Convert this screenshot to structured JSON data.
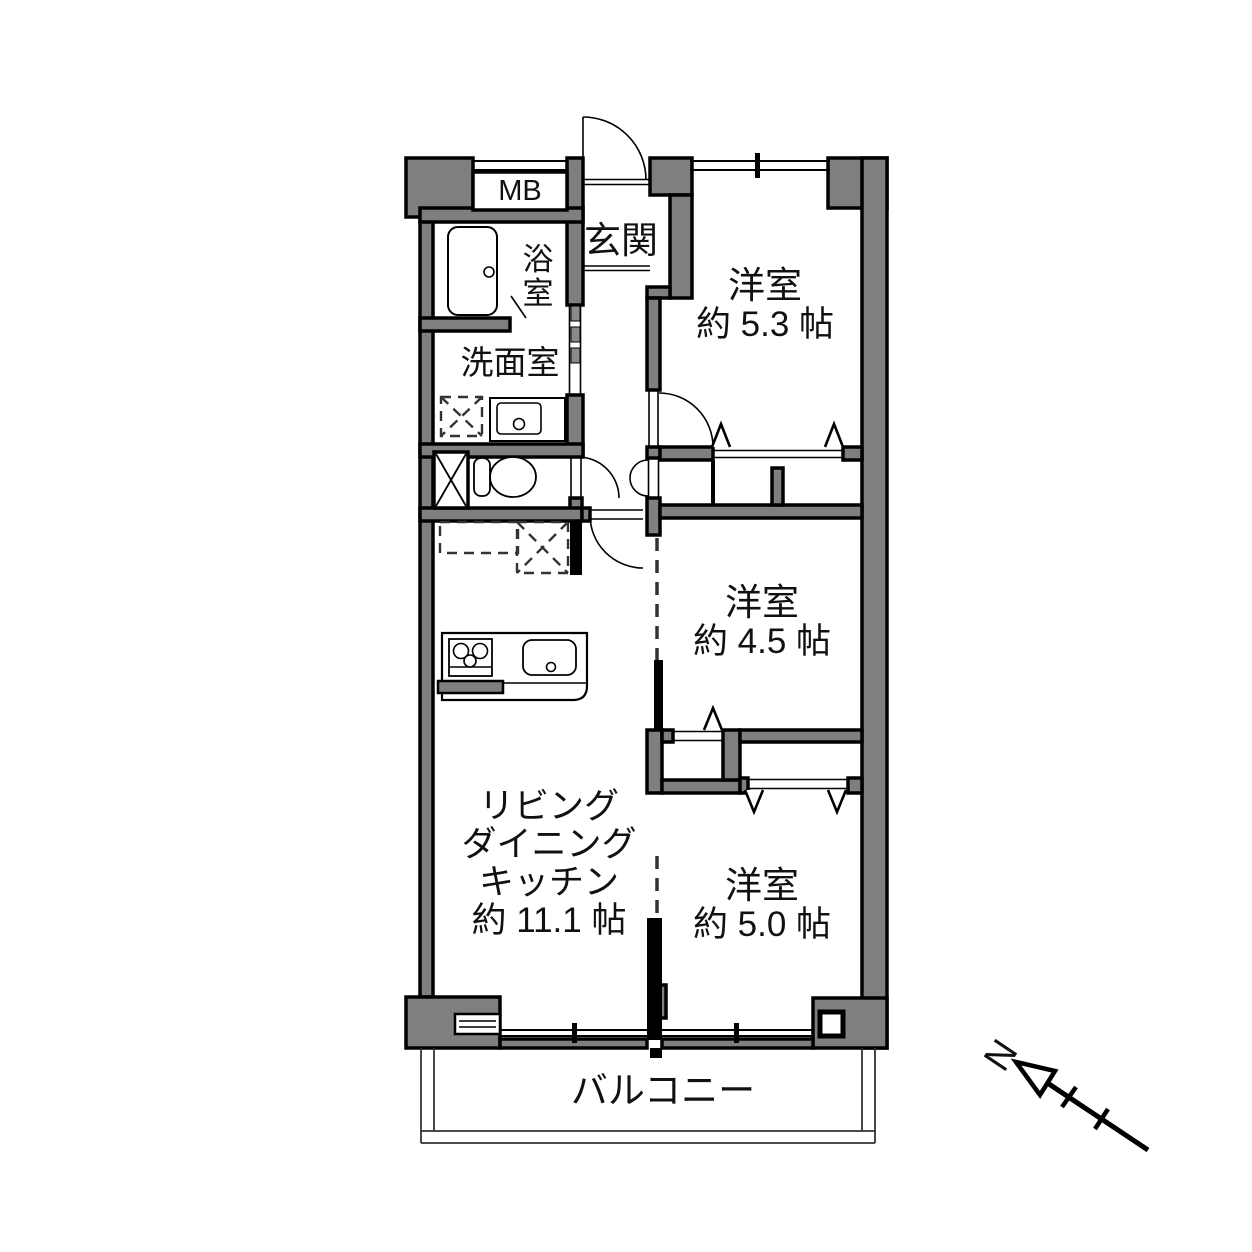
{
  "plan": {
    "type": "apartment-floor-plan",
    "rooms": {
      "bedroom_upper": {
        "name": "洋室",
        "size": "約 5.3 帖"
      },
      "bedroom_middle": {
        "name": "洋室",
        "size": "約 4.5 帖"
      },
      "bedroom_lower": {
        "name": "洋室",
        "size": "約 5.0 帖"
      },
      "ldk": {
        "line1": "リビング",
        "line2": "ダイニング",
        "line3": "キッチン",
        "size": "約 11.1 帖"
      },
      "entrance": {
        "name": "玄関"
      },
      "bathroom": {
        "char1": "浴",
        "char2": "室"
      },
      "washroom": {
        "name": "洗面室"
      },
      "meter_box": {
        "label": "MB"
      },
      "balcony": {
        "name": "バルコニー"
      }
    },
    "compass": {
      "north_label": "N"
    },
    "colors": {
      "wall_fill": "#7f7f7f",
      "wall_outline": "#000000",
      "background": "#ffffff",
      "text": "#111111"
    }
  }
}
